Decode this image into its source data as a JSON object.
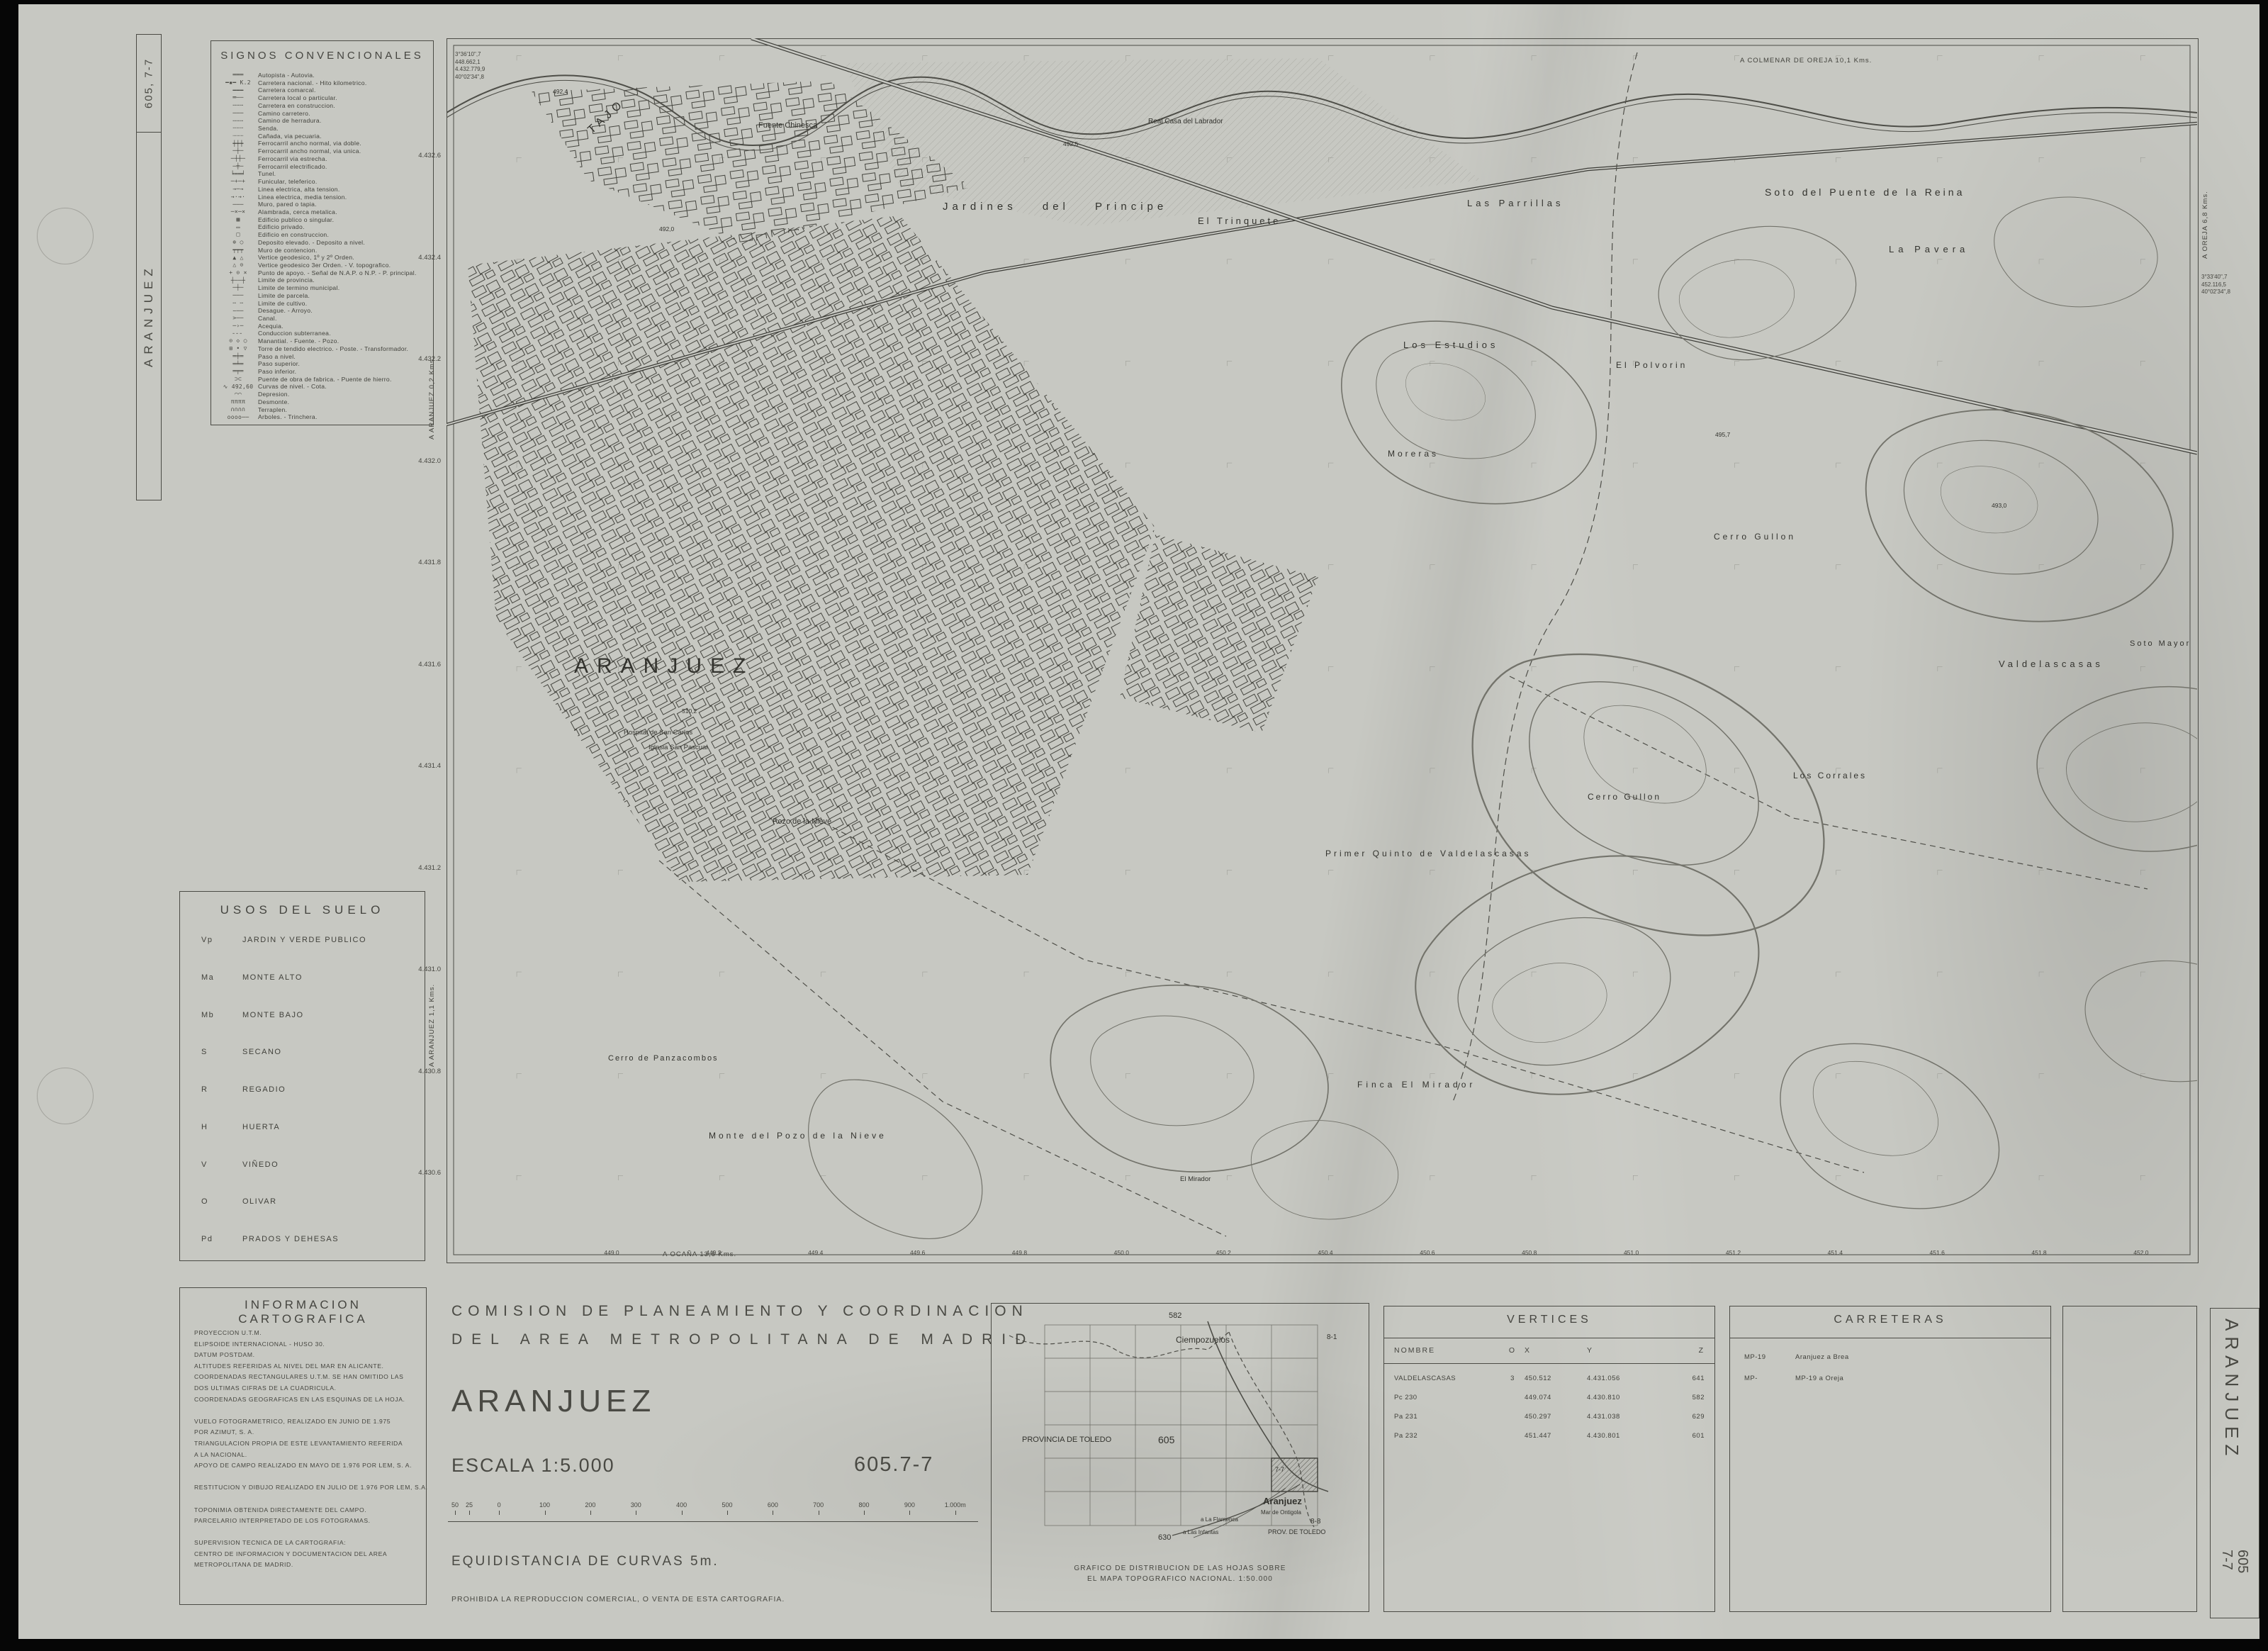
{
  "sheet": {
    "paper_color": "#c7c8c2",
    "ink_color": "#3a3a35",
    "left_margin": {
      "code_vertical": "605, 7-7",
      "name_vertical": "ARANJUEZ"
    },
    "right_margin": {
      "name_vertical": "ARANJUEZ",
      "code_line1": "605",
      "code_line2": "7-7"
    }
  },
  "legend": {
    "title": "SIGNOS CONVENCIONALES",
    "items": [
      {
        "sym": "═══",
        "label": "Autopista - Autovia."
      },
      {
        "sym": "━▪━ K.2",
        "label": "Carretera nacional. - Hito kilometrico."
      },
      {
        "sym": "━━━",
        "label": "Carretera comarcal."
      },
      {
        "sym": "═──",
        "label": "Carretera local o particular."
      },
      {
        "sym": "╌╌╌",
        "label": "Carretera en construccion."
      },
      {
        "sym": "───",
        "label": "Camino carretero."
      },
      {
        "sym": "╌╌╌",
        "label": "Camino de herradura."
      },
      {
        "sym": "┄┄┄",
        "label": "Senda."
      },
      {
        "sym": "┈┈┈",
        "label": "Cañada, via pecuaria."
      },
      {
        "sym": "┿┿┿",
        "label": "Ferrocarril ancho normal, via doble."
      },
      {
        "sym": "─┼─",
        "label": "Ferrocarril ancho normal, via unica."
      },
      {
        "sym": "─┼┼─",
        "label": "Ferrocarril via estrecha."
      },
      {
        "sym": "─╪─",
        "label": "Ferrocarril electrificado."
      },
      {
        "sym": "╘══╛",
        "label": "Tunel."
      },
      {
        "sym": "─+─+",
        "label": "Funicular, teleferico."
      },
      {
        "sym": "→─→",
        "label": "Linea electrica, alta tension."
      },
      {
        "sym": "→·→·",
        "label": "Linea electrica, media tension."
      },
      {
        "sym": "───",
        "label": "Muro, pared o tapia."
      },
      {
        "sym": "─×─×",
        "label": "Alambrada, cerca metalica."
      },
      {
        "sym": "▩",
        "label": "Edificio publico o singular."
      },
      {
        "sym": "▭",
        "label": "Edificio privado."
      },
      {
        "sym": "□",
        "label": "Edificio en construccion."
      },
      {
        "sym": "⊕ ○",
        "label": "Deposito elevado. - Deposito a nivel."
      },
      {
        "sym": "┯┯┯",
        "label": "Muro de contencion."
      },
      {
        "sym": "▲ △",
        "label": "Vertice geodesico, 1º y 2º Orden."
      },
      {
        "sym": "△ ⊙",
        "label": "Vertice geodesico 3er Orden. - V. topografico."
      },
      {
        "sym": "+ ⊙ ×",
        "label": "Punto de apoyo. - Señal de N.A.P. o N.P. - P. principal."
      },
      {
        "sym": "┼──┼",
        "label": "Limite de provincia."
      },
      {
        "sym": "─┼─",
        "label": "Limite de termino municipal."
      },
      {
        "sym": "───",
        "label": "Limite de parcela."
      },
      {
        "sym": "╌ ╌",
        "label": "Limite de cultivo."
      },
      {
        "sym": "∼──",
        "label": "Desague. - Arroyo."
      },
      {
        "sym": ">──",
        "label": "Canal."
      },
      {
        "sym": "─›─",
        "label": "Acequia."
      },
      {
        "sym": "╴╴╴",
        "label": "Conduccion subterranea."
      },
      {
        "sym": "⊙ ◇ ○",
        "label": "Manantial. - Fuente. - Pozo."
      },
      {
        "sym": "⊞ • ▽",
        "label": "Torre de tendido electrico. - Poste. - Transformador."
      },
      {
        "sym": "═╪═",
        "label": "Paso a nivel."
      },
      {
        "sym": "═╧═",
        "label": "Paso superior."
      },
      {
        "sym": "═╤═",
        "label": "Paso inferior."
      },
      {
        "sym": "⊃⊂",
        "label": "Puente de obra de fabrica. - Puente de hierro."
      },
      {
        "sym": "∿ 492,60",
        "label": "Curvas de nivel. - Cota."
      },
      {
        "sym": "⌒⌒",
        "label": "Depresion."
      },
      {
        "sym": "ππππ",
        "label": "Desmonte."
      },
      {
        "sym": "∩∩∩∩",
        "label": "Terraplen."
      },
      {
        "sym": "oooo──",
        "label": "Arboles. - Trinchera."
      }
    ]
  },
  "land_use": {
    "title": "USOS DEL SUELO",
    "items": [
      {
        "code": "Vp",
        "label": "JARDIN Y VERDE PUBLICO"
      },
      {
        "code": "Ma",
        "label": "MONTE ALTO"
      },
      {
        "code": "Mb",
        "label": "MONTE BAJO"
      },
      {
        "code": "S",
        "label": "SECANO"
      },
      {
        "code": "R",
        "label": "REGADIO"
      },
      {
        "code": "H",
        "label": "HUERTA"
      },
      {
        "code": "V",
        "label": "VIÑEDO"
      },
      {
        "code": "O",
        "label": "OLIVAR"
      },
      {
        "code": "Pd",
        "label": "PRADOS Y DEHESAS"
      }
    ]
  },
  "carto_info": {
    "title": "INFORMACION CARTOGRAFICA",
    "lines": [
      "PROYECCION U.T.M.",
      "ELIPSOIDE INTERNACIONAL - HUSO 30.",
      "DATUM POSTDAM.",
      "ALTITUDES REFERIDAS AL NIVEL DEL MAR EN ALICANTE.",
      "COORDENADAS RECTANGULARES U.T.M. SE HAN OMITIDO LAS",
      "DOS ULTIMAS CIFRAS DE LA CUADRICULA.",
      "COORDENADAS GEOGRAFICAS EN LAS ESQUINAS DE LA HOJA.",
      "",
      "VUELO FOTOGRAMETRICO, REALIZADO EN JUNIO DE 1.975",
      "POR AZIMUT, S. A.",
      "TRIANGULACION PROPIA DE ESTE LEVANTAMIENTO REFERIDA",
      "A LA NACIONAL.",
      "APOYO DE CAMPO REALIZADO EN MAYO DE 1.976 POR LEM, S. A.",
      "",
      "RESTITUCION Y DIBUJO REALIZADO EN JULIO DE 1.976 POR LEM, S.A.",
      "",
      "TOPONIMIA OBTENIDA DIRECTAMENTE DEL CAMPO.",
      "PARCELARIO INTERPRETADO DE LOS FOTOGRAMAS.",
      "",
      "SUPERVISION TECNICA DE LA CARTOGRAFIA:",
      "CENTRO DE INFORMACION Y DOCUMENTACION DEL AREA",
      "METROPOLITANA DE MADRID."
    ]
  },
  "title_block": {
    "org_line1": "COMISION DE PLANEAMIENTO Y COORDINACION",
    "org_line2": "DEL AREA METROPOLITANA DE MADRID",
    "sheet_name": "ARANJUEZ",
    "scale_label": "ESCALA 1:5.000",
    "sheet_code": "605.7-7",
    "equidistance": "EQUIDISTANCIA DE CURVAS 5m.",
    "copyright": "PROHIBIDA LA REPRODUCCION COMERCIAL, O VENTA DE ESTA CARTOGRAFIA.",
    "scale_bar_labels": [
      "50",
      "25",
      "0",
      "100",
      "200",
      "300",
      "400",
      "500",
      "600",
      "700",
      "800",
      "900",
      "1.000m"
    ]
  },
  "inset": {
    "caption_line1": "GRAFICO DE DISTRIBUCION DE LAS HOJAS SOBRE",
    "caption_line2": "EL MAPA TOPOGRAFICO NACIONAL.     1:50.000",
    "labels": {
      "n582": "582",
      "ciempozuelos": "Ciempozuelos",
      "c81": "8-1",
      "prov_toledo": "PROVINCIA  DE  TOLEDO",
      "n605": "605",
      "aranjuez": "Aranjuez",
      "c77": "7-7",
      "ontigola": "Mar de Ontigola",
      "flamenca": "a La Flamenca",
      "infantas": "a Las Infantas",
      "c88": "8-8",
      "prov_toledo2": "PROV. DE TOLEDO",
      "n630": "630"
    }
  },
  "vertices": {
    "title": "VERTICES",
    "headers": [
      "NOMBRE",
      "O",
      "X",
      "Y",
      "Z"
    ],
    "rows": [
      {
        "name": "VALDELASCASAS",
        "o": "3",
        "x": "450.512",
        "y": "4.431.056",
        "z": "641"
      },
      {
        "name": "Pc 230",
        "o": "",
        "x": "449.074",
        "y": "4.430.810",
        "z": "582"
      },
      {
        "name": "Pa 231",
        "o": "",
        "x": "450.297",
        "y": "4.431.038",
        "z": "629"
      },
      {
        "name": "Pa 232",
        "o": "",
        "x": "451.447",
        "y": "4.430.801",
        "z": "601"
      }
    ]
  },
  "carreteras": {
    "title": "CARRETERAS",
    "rows": [
      {
        "code": "MP-19",
        "dest": "Aranjuez a Brea"
      },
      {
        "code": "MP-",
        "dest": "MP-19 a Oreja"
      }
    ]
  },
  "map": {
    "margin_top": "A  COLMENAR  DE  OREJA  10,1  Kms.",
    "margin_bottom": "A  OCAÑA  13,6  Kms.",
    "margin_left_top": "A  ARANJUEZ  0,2  Kms.",
    "margin_left_bottom": "A  ARANJUEZ  1,1  Kms.",
    "margin_right": "A  OREJA  6,8  Kms.",
    "corner_top_left": [
      "3°36'10\",7",
      "448.662,1",
      "4.432.779,9",
      "40°02'34\",8"
    ],
    "corner_top_right": [
      "3°33'40\",7",
      "452.116,5",
      "40°02'34\",8"
    ],
    "grid_left": [
      "4.432.6",
      "4.432.4",
      "4.432.2",
      "4.432.0",
      "4.431.8",
      "4.431.6",
      "4.431.4",
      "4.431.2",
      "4.431.0",
      "4.430.8",
      "4.430.6"
    ],
    "grid_bottom": [
      "449.0",
      "449.2",
      "449.4",
      "449.6",
      "449.8",
      "450.0",
      "450.2",
      "450.4",
      "450.6",
      "450.8",
      "451.0",
      "451.2",
      "451.4",
      "451.6",
      "451.8",
      "452.0"
    ],
    "labels": {
      "city": "ARANJUEZ",
      "rio": "TAJO",
      "fuente_chinesca": "Fuente Chinesca",
      "real_casa": "Real Casa del Labrador",
      "jardines": "Jardines  del  Principe",
      "trinquete": "El  Trinquete",
      "parrillas": "Las  Parrillas",
      "soto_puente": "Soto  del  Puente  de la  Reina",
      "pavera": "La  Pavera",
      "estudios": "Los  Estudios",
      "polvorin": "El  Polvorin",
      "moreras": "Moreras",
      "cerro_gullon1": "Cerro  Gullon",
      "valdelascasas": "Valdelascasas",
      "soto_mayor": "Soto  Mayor",
      "corrales": "Los  Corrales",
      "cerro_gullon2": "Cerro  Gullon",
      "primer_quinto": "Primer  Quinto  de  Valdelascasas",
      "hospital": "Hospital de San Carlos",
      "iglesia": "Iglesia San Pascual",
      "pozo_nieve": "Pozo de la Nieve",
      "cerro_panza": "Cerro de Panzacombos",
      "monte_pozo": "Monte  del  Pozo  de  la  Nieve",
      "finca_mirador": "Finca  El  Mirador",
      "mirador": "El Mirador"
    },
    "spot_heights": [
      "492,4",
      "492,0",
      "492,5",
      "493,0",
      "495,7",
      "510,2"
    ]
  }
}
